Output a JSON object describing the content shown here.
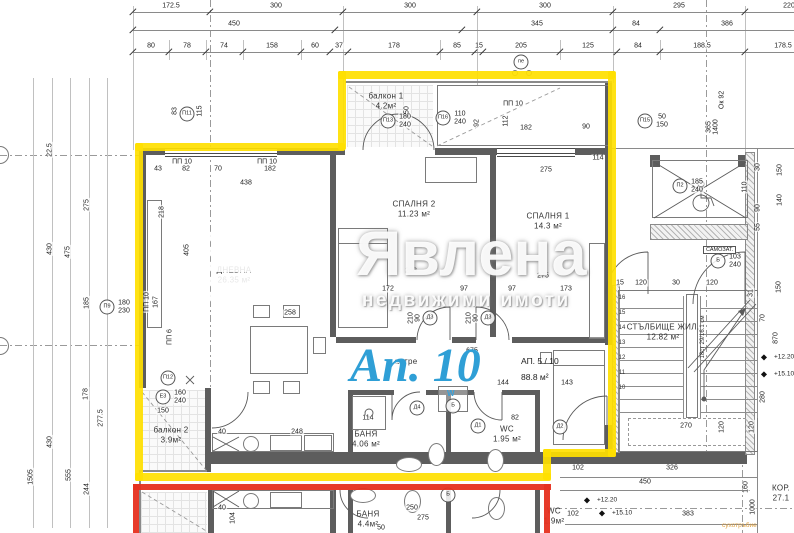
{
  "watermark": {
    "brand": "Явлена",
    "tagline": "недвижими имоти"
  },
  "highlight": {
    "big_label": "Ап. 10",
    "unit": "АП. 5 / 10",
    "area": "88.8 м²",
    "yellow": "#ffdf00",
    "red": "#e6301f",
    "blue": "#2f9fd6"
  },
  "misc": {
    "samozat": "САМОЗАТ.",
    "dry_riser": "сухотръбие",
    "steps_note": "18ст 29/16.1 см",
    "washer": "W"
  },
  "rooms": [
    {
      "n": "ДНЕВНА",
      "a": "26.35 м²",
      "x": 234,
      "y": 276
    },
    {
      "n": "СПАЛНЯ 2",
      "a": "11.23 м²",
      "x": 414,
      "y": 210
    },
    {
      "n": "СПАЛНЯ 1",
      "a": "14.3 м²",
      "x": 548,
      "y": 222
    },
    {
      "n": "балкон 1",
      "a": "4.2м²",
      "x": 386,
      "y": 102
    },
    {
      "n": "балкон 2",
      "a": "3.9м²",
      "x": 171,
      "y": 436
    },
    {
      "n": "БАНЯ",
      "a": "4.06 м²",
      "x": 366,
      "y": 440
    },
    {
      "n": "WC",
      "a": "1.95 м²",
      "x": 507,
      "y": 435
    },
    {
      "n": "антре",
      "a": "",
      "x": 406,
      "y": 362
    },
    {
      "n": "СТЪЛБИЩЕ ЖИЛ.",
      "a": "12.82 м²",
      "x": 663,
      "y": 333
    },
    {
      "n": "БАНЯ",
      "a": "4.4м²",
      "x": 368,
      "y": 520
    },
    {
      "n": "WC",
      "a": "1.9м²",
      "x": 554,
      "y": 517
    },
    {
      "n": "КОР.",
      "a": "27.1",
      "x": 781,
      "y": 494
    }
  ],
  "dim_rows": [
    {
      "y": 12,
      "ly": 6,
      "ticks": [
        133,
        210,
        343,
        477,
        613,
        745
      ],
      "labels": [
        {
          "t": "172.5",
          "x": 171
        },
        {
          "t": "300",
          "x": 276
        },
        {
          "t": "300",
          "x": 410
        },
        {
          "t": "300",
          "x": 545
        },
        {
          "t": "295",
          "x": 679
        },
        {
          "t": "220",
          "x": 789
        }
      ]
    },
    {
      "y": 30,
      "ly": 24,
      "ticks": [
        133,
        335,
        462,
        613,
        660
      ],
      "labels": [
        {
          "t": "450",
          "x": 234
        },
        {
          "t": "345",
          "x": 537
        },
        {
          "t": "84",
          "x": 636
        },
        {
          "t": "386",
          "x": 727
        }
      ]
    },
    {
      "y": 52,
      "ly": 46,
      "ticks": [
        133,
        169,
        206,
        243,
        301,
        330,
        348,
        440,
        475,
        483,
        560,
        617,
        660,
        745
      ],
      "labels": [
        {
          "t": "80",
          "x": 151
        },
        {
          "t": "78",
          "x": 187
        },
        {
          "t": "74",
          "x": 224
        },
        {
          "t": "158",
          "x": 272
        },
        {
          "t": "60",
          "x": 315
        },
        {
          "t": "37",
          "x": 339
        },
        {
          "t": "178",
          "x": 394
        },
        {
          "t": "85",
          "x": 457
        },
        {
          "t": "15",
          "x": 479
        },
        {
          "t": "205",
          "x": 521
        },
        {
          "t": "125",
          "x": 588
        },
        {
          "t": "84",
          "x": 638
        },
        {
          "t": "188.5",
          "x": 702
        },
        {
          "t": "178.5",
          "x": 783
        }
      ]
    }
  ],
  "dims": [
    {
      "t": "43",
      "x": 158,
      "y": 169
    },
    {
      "t": "82",
      "x": 186,
      "y": 169
    },
    {
      "t": "70",
      "x": 218,
      "y": 169
    },
    {
      "t": "182",
      "x": 270,
      "y": 169
    },
    {
      "t": "438",
      "x": 246,
      "y": 183
    },
    {
      "t": "ПП 10",
      "x": 182,
      "y": 162
    },
    {
      "t": "ПП 10",
      "x": 267,
      "y": 162
    },
    {
      "t": "ПП 10",
      "x": 513,
      "y": 104
    },
    {
      "t": "218",
      "x": 162,
      "y": 212,
      "r": 1
    },
    {
      "t": "405",
      "x": 187,
      "y": 250,
      "r": 1
    },
    {
      "t": "ПП 10",
      "x": 147,
      "y": 302,
      "r": 1
    },
    {
      "t": "167",
      "x": 156,
      "y": 302,
      "r": 1
    },
    {
      "t": "ПП 6",
      "x": 170,
      "y": 337,
      "r": 1
    },
    {
      "t": "150",
      "x": 407,
      "y": 112,
      "r": 1
    },
    {
      "t": "92",
      "x": 477,
      "y": 123,
      "r": 1
    },
    {
      "t": "112",
      "x": 506,
      "y": 121,
      "r": 1
    },
    {
      "t": "182",
      "x": 526,
      "y": 128
    },
    {
      "t": "90",
      "x": 586,
      "y": 127
    },
    {
      "t": "275",
      "x": 546,
      "y": 170
    },
    {
      "t": "275",
      "x": 543,
      "y": 276
    },
    {
      "t": "288",
      "x": 411,
      "y": 271
    },
    {
      "t": "172",
      "x": 388,
      "y": 289
    },
    {
      "t": "97",
      "x": 464,
      "y": 289
    },
    {
      "t": "97",
      "x": 512,
      "y": 289
    },
    {
      "t": "173",
      "x": 566,
      "y": 289
    },
    {
      "t": "258",
      "x": 290,
      "y": 313
    },
    {
      "t": "150",
      "x": 163,
      "y": 411
    },
    {
      "t": "40",
      "x": 222,
      "y": 432
    },
    {
      "t": "248",
      "x": 297,
      "y": 432
    },
    {
      "t": "114",
      "x": 368,
      "y": 418
    },
    {
      "t": "82",
      "x": 515,
      "y": 418
    },
    {
      "t": "675",
      "x": 472,
      "y": 351
    },
    {
      "t": "144",
      "x": 503,
      "y": 383
    },
    {
      "t": "143",
      "x": 567,
      "y": 383
    },
    {
      "t": "40",
      "x": 222,
      "y": 508
    },
    {
      "t": "104",
      "x": 233,
      "y": 518,
      "r": 1
    },
    {
      "t": "250",
      "x": 412,
      "y": 508
    },
    {
      "t": "275",
      "x": 423,
      "y": 518
    },
    {
      "t": "50",
      "x": 381,
      "y": 528
    },
    {
      "t": "114",
      "x": 598,
      "y": 158
    },
    {
      "t": "22.5",
      "x": 50,
      "y": 150,
      "r": 1
    },
    {
      "t": "275",
      "x": 87,
      "y": 205,
      "r": 1
    },
    {
      "t": "430",
      "x": 50,
      "y": 249,
      "r": 1
    },
    {
      "t": "475",
      "x": 68,
      "y": 252,
      "r": 1
    },
    {
      "t": "185",
      "x": 87,
      "y": 303,
      "r": 1
    },
    {
      "t": "178",
      "x": 86,
      "y": 394,
      "r": 1
    },
    {
      "t": "277.5",
      "x": 101,
      "y": 418,
      "r": 1
    },
    {
      "t": "430",
      "x": 50,
      "y": 442,
      "r": 1
    },
    {
      "t": "1505",
      "x": 31,
      "y": 477,
      "r": 1
    },
    {
      "t": "555",
      "x": 69,
      "y": 475,
      "r": 1
    },
    {
      "t": "244",
      "x": 87,
      "y": 489,
      "r": 1
    },
    {
      "t": "83",
      "x": 175,
      "y": 111,
      "r": 1
    },
    {
      "t": "115",
      "x": 200,
      "y": 111,
      "r": 1
    },
    {
      "t": "150",
      "x": 780,
      "y": 170,
      "r": 1
    },
    {
      "t": "140",
      "x": 780,
      "y": 200,
      "r": 1
    },
    {
      "t": "30",
      "x": 758,
      "y": 167,
      "r": 1
    },
    {
      "t": "110",
      "x": 745,
      "y": 187,
      "r": 1
    },
    {
      "t": "90",
      "x": 758,
      "y": 208,
      "r": 1
    },
    {
      "t": "55",
      "x": 758,
      "y": 227,
      "r": 1
    },
    {
      "t": "870",
      "x": 776,
      "y": 338,
      "r": 1
    },
    {
      "t": "280",
      "x": 763,
      "y": 397,
      "r": 1
    },
    {
      "t": "150",
      "x": 779,
      "y": 287,
      "r": 1
    },
    {
      "t": "70",
      "x": 763,
      "y": 318,
      "r": 1
    },
    {
      "t": "31",
      "x": 751,
      "y": 293,
      "r": 1
    },
    {
      "t": "Ок 92",
      "x": 722,
      "y": 100,
      "r": 1
    },
    {
      "t": "365",
      "x": 709,
      "y": 127,
      "r": 1
    },
    {
      "t": "1400",
      "x": 716,
      "y": 127,
      "r": 1
    },
    {
      "t": "15",
      "x": 620,
      "y": 283
    },
    {
      "t": "120",
      "x": 641,
      "y": 283
    },
    {
      "t": "30",
      "x": 676,
      "y": 283
    },
    {
      "t": "120",
      "x": 712,
      "y": 283
    },
    {
      "t": "270",
      "x": 686,
      "y": 426
    },
    {
      "t": "120",
      "x": 722,
      "y": 427,
      "r": 1
    },
    {
      "t": "120",
      "x": 752,
      "y": 427,
      "r": 1
    },
    {
      "t": "102",
      "x": 578,
      "y": 468
    },
    {
      "t": "326",
      "x": 672,
      "y": 468
    },
    {
      "t": "450",
      "x": 645,
      "y": 482
    },
    {
      "t": "102",
      "x": 573,
      "y": 514
    },
    {
      "t": "383",
      "x": 688,
      "y": 514
    },
    {
      "t": "160",
      "x": 746,
      "y": 487,
      "r": 1
    },
    {
      "t": "1000",
      "x": 753,
      "y": 507,
      "r": 1
    }
  ],
  "tags": [
    {
      "c": "пе",
      "x": 521,
      "y": 62
    },
    {
      "c": "П11",
      "x": 187,
      "y": 114
    },
    {
      "c": "П13",
      "x": 388,
      "y": 121,
      "s1": "180",
      "s2": "240"
    },
    {
      "c": "П16",
      "x": 443,
      "y": 118,
      "s1": "110",
      "s2": "240"
    },
    {
      "c": "П15",
      "x": 645,
      "y": 121,
      "s1": "50",
      "s2": "150"
    },
    {
      "c": "П2",
      "x": 680,
      "y": 186,
      "s1": "185",
      "s2": "240"
    },
    {
      "c": "П9",
      "x": 107,
      "y": 307,
      "s1": "180",
      "s2": "230"
    },
    {
      "c": "П12",
      "x": 168,
      "y": 378
    },
    {
      "c": "Е3",
      "x": 163,
      "y": 397,
      "s1": "160",
      "s2": "240"
    },
    {
      "c": "Д3",
      "x": 430,
      "y": 318,
      "s1": "90",
      "s2": "210",
      "r": 1
    },
    {
      "c": "Д3",
      "x": 488,
      "y": 318,
      "s1": "90",
      "s2": "210",
      "r": 1
    },
    {
      "c": "Д4",
      "x": 417,
      "y": 408
    },
    {
      "c": "Б",
      "x": 453,
      "y": 406
    },
    {
      "c": "Д1",
      "x": 478,
      "y": 426
    },
    {
      "c": "Д2",
      "x": 560,
      "y": 427
    },
    {
      "c": "Б",
      "x": 718,
      "y": 261,
      "s1": "103",
      "s2": "240"
    },
    {
      "c": "Б",
      "x": 448,
      "y": 495
    }
  ],
  "elevations": [
    {
      "t": "+12.20",
      "x": 597,
      "y": 500
    },
    {
      "t": "+15.10",
      "x": 612,
      "y": 513
    },
    {
      "t": "+12.20",
      "x": 774,
      "y": 357
    },
    {
      "t": "+15.10",
      "x": 774,
      "y": 374
    }
  ],
  "stairs": {
    "step_numbers": [
      "16",
      "15",
      "14",
      "13",
      "12",
      "11",
      "10"
    ]
  }
}
